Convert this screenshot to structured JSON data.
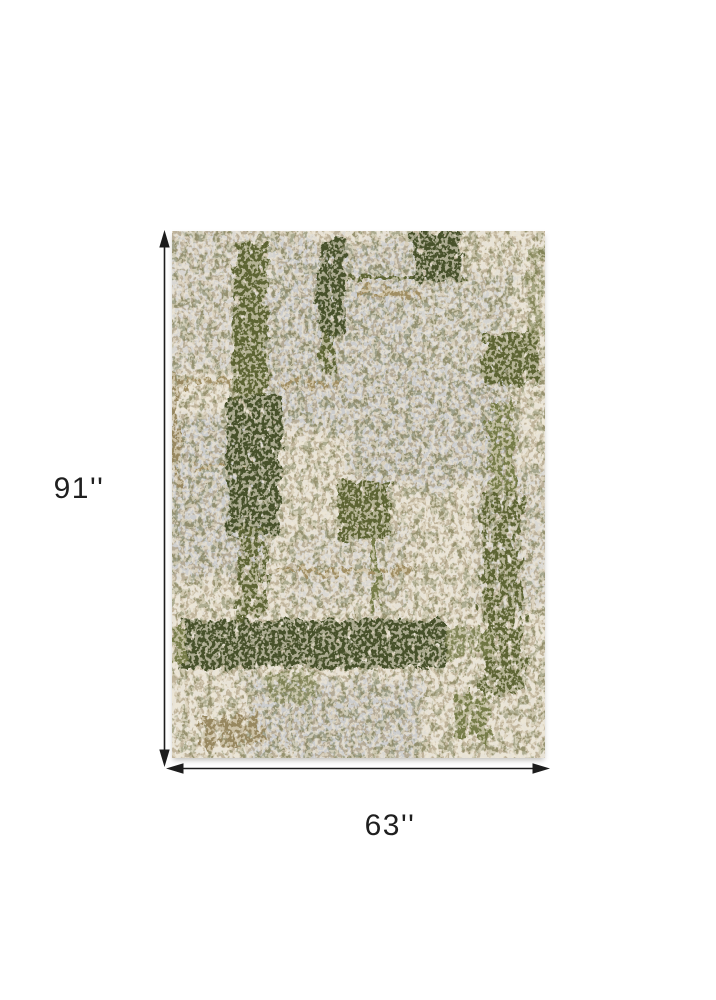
{
  "product_diagram": {
    "height_label": "91''",
    "width_label": "63''"
  },
  "colors": {
    "canvas_background": "#ffffff",
    "dimension_line": "#1c1c1c",
    "label_text": "#1f1f1f",
    "rug_ivory": "#e8e3d7",
    "rug_grey": "#c8cacd",
    "rug_olive_dark": "#47512a",
    "rug_olive_mid": "#5d6433",
    "rug_khaki": "#767c48",
    "rug_tan": "#a08e62",
    "rug_brown": "#97875f"
  }
}
